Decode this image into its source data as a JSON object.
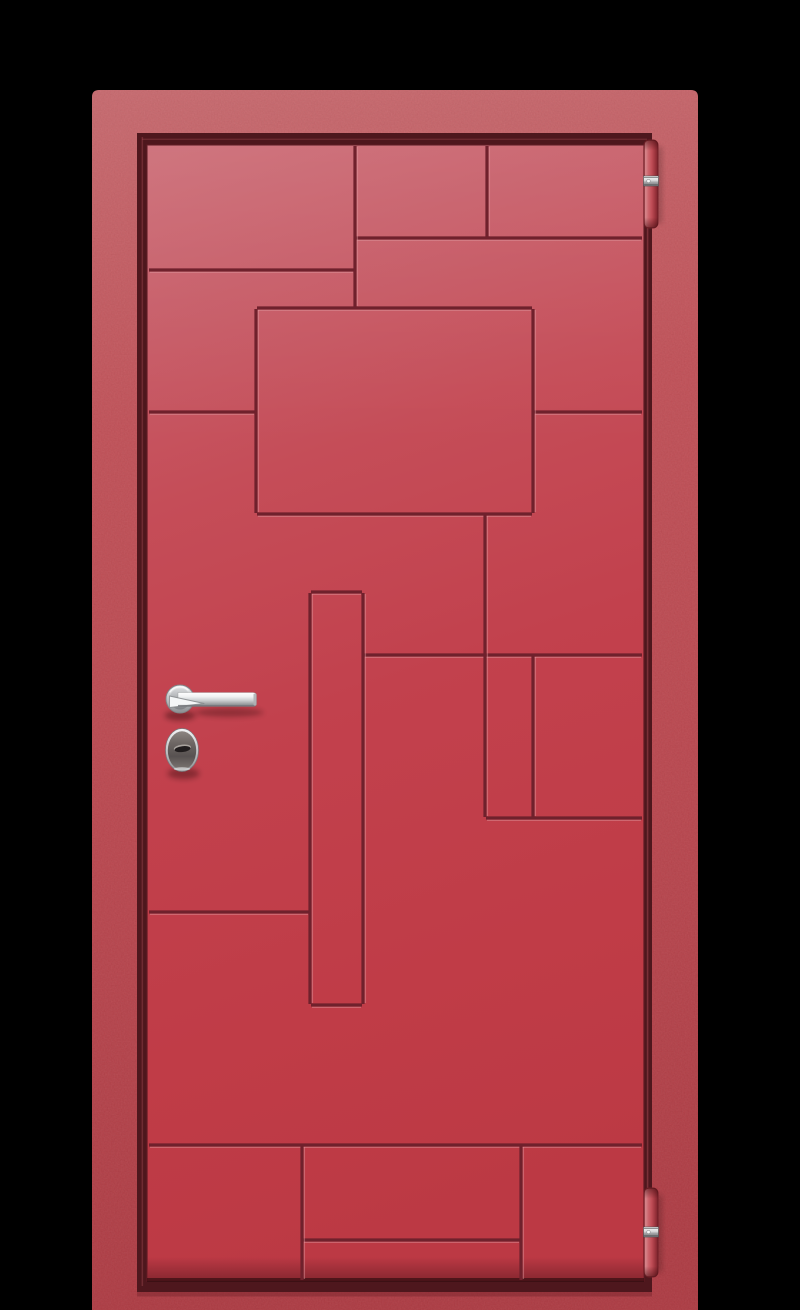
{
  "scene": {
    "type": "product-render",
    "subject": "red entry door with geometric groove pattern, chrome lever handle, oval keyhole escutcheon and two barrel hinges on black background",
    "background_color": "#000000",
    "width": 800,
    "height": 1310
  },
  "frame": {
    "x": 92,
    "y": 90,
    "right": 698,
    "bottom": 1310,
    "top_corner_radius": 7,
    "gradient": [
      [
        0,
        "#ca6c71"
      ],
      [
        0.28,
        "#c35259"
      ],
      [
        0.62,
        "#bc4850"
      ],
      [
        1,
        "#b03d45"
      ]
    ],
    "noise_opacity_light": 0.07,
    "noise_opacity_dark": 0.06,
    "rebate": {
      "x": 137,
      "y": 133,
      "right": 652,
      "bottom": 1292,
      "color": "#4e171d"
    },
    "gap_highlight_color": "#a34a52",
    "sill_shadow": {
      "y": 1292,
      "h": 4.5,
      "color": "#7c262e",
      "opacity": 0.5
    }
  },
  "leaf": {
    "x": 147,
    "y": 145,
    "right": 644,
    "bottom": 1281,
    "gradient": [
      [
        0,
        "#cb6a74"
      ],
      [
        0.13,
        "#c75d68"
      ],
      [
        0.3,
        "#c54d58"
      ],
      [
        0.52,
        "#c2414d"
      ],
      [
        0.78,
        "#c03c47"
      ],
      [
        1,
        "#bc3944"
      ]
    ],
    "edge_color": "#5e1b23",
    "bottom_shade_color": "#7c232c",
    "bottom_dark_color": "#2e0a0e",
    "sheen_height": 300,
    "sheen_opacity": 0.5
  },
  "grooves": {
    "dark_color": "#6f212c",
    "light_color": "#e09aa0",
    "dark_width": 3.2,
    "light_width": 1.3,
    "light_opacity": 0.45,
    "horizontal": [
      {
        "y": 238,
        "x1": 355,
        "x2": 643
      },
      {
        "y": 270,
        "x1": 148,
        "x2": 355
      },
      {
        "y": 308,
        "x1": 256,
        "x2": 533
      },
      {
        "y": 412,
        "x1": 148,
        "x2": 256
      },
      {
        "y": 412,
        "x1": 533,
        "x2": 643
      },
      {
        "y": 514,
        "x1": 256,
        "x2": 533
      },
      {
        "y": 592,
        "x1": 310,
        "x2": 363
      },
      {
        "y": 655,
        "x1": 363,
        "x2": 643
      },
      {
        "y": 818,
        "x1": 485,
        "x2": 643
      },
      {
        "y": 912,
        "x1": 148,
        "x2": 310
      },
      {
        "y": 1005,
        "x1": 310,
        "x2": 363
      },
      {
        "y": 1145,
        "x1": 148,
        "x2": 643
      },
      {
        "y": 1240,
        "x1": 302,
        "x2": 521
      }
    ],
    "vertical": [
      {
        "x": 355,
        "y1": 145,
        "y2": 308
      },
      {
        "x": 487,
        "y1": 145,
        "y2": 238
      },
      {
        "x": 256,
        "y1": 308,
        "y2": 514
      },
      {
        "x": 533,
        "y1": 308,
        "y2": 514
      },
      {
        "x": 310,
        "y1": 592,
        "y2": 1005
      },
      {
        "x": 363,
        "y1": 592,
        "y2": 1005
      },
      {
        "x": 485,
        "y1": 514,
        "y2": 818
      },
      {
        "x": 533,
        "y1": 655,
        "y2": 818
      },
      {
        "x": 302,
        "y1": 1145,
        "y2": 1281
      },
      {
        "x": 521,
        "y1": 1145,
        "y2": 1281
      }
    ]
  },
  "hinges": {
    "body_gradient": [
      [
        0,
        "#8e2d36"
      ],
      [
        0.1,
        "#d8898e"
      ],
      [
        0.32,
        "#cc646c"
      ],
      [
        0.55,
        "#bf4d56"
      ],
      [
        0.8,
        "#9c343d"
      ],
      [
        1,
        "#7a242c"
      ]
    ],
    "cap_shade_color": "#3c0a0e",
    "band_gradient": [
      [
        0,
        "#fafafa"
      ],
      [
        0.45,
        "#d8d9da"
      ],
      [
        0.62,
        "#a6a7a9"
      ],
      [
        1,
        "#737477"
      ]
    ],
    "outline": "#6f1d25",
    "items": [
      {
        "id": "hinge-top",
        "x": 644,
        "y": 140,
        "w": 14,
        "h": 88,
        "band_y": 176,
        "band_h": 10
      },
      {
        "id": "hinge-bottom",
        "x": 644,
        "y": 1188,
        "w": 14,
        "h": 89,
        "band_y": 1227,
        "band_h": 10
      }
    ]
  },
  "handle": {
    "rosette": {
      "cx": 180,
      "cy": 699,
      "r": 14,
      "inner_r": 10.5
    },
    "lever": {
      "x1": 178,
      "x2": 256.5,
      "top": 692.5,
      "bottom": 706.5,
      "wedge": [
        [
          169.5,
          696
        ],
        [
          169.5,
          707.5
        ],
        [
          204,
          703.5
        ]
      ]
    },
    "chrome_gradient": [
      [
        0,
        "#ffffff"
      ],
      [
        0.3,
        "#eff1f2"
      ],
      [
        0.55,
        "#ced1d3"
      ],
      [
        0.8,
        "#a0a3a6"
      ],
      [
        1,
        "#828588"
      ]
    ],
    "rosette_gradient": [
      [
        0,
        "#eceeef"
      ],
      [
        0.55,
        "#b9bcbe"
      ],
      [
        1,
        "#8b8e91"
      ]
    ],
    "rosette_inner_gradient": [
      [
        0,
        "#d6d8da"
      ],
      [
        1,
        "#7d8084"
      ]
    ],
    "wedge_fill": "#f4f6f7",
    "wedge_edge": "#85888b",
    "shadow_color": "#160304"
  },
  "lock": {
    "cx": 182,
    "cy": 750,
    "rx": 16.5,
    "ry": 21.5,
    "rim_gradient": [
      [
        0,
        "#f3f4f5"
      ],
      [
        0.5,
        "#c3c5c7"
      ],
      [
        1,
        "#8f9295"
      ]
    ],
    "face_gradient": [
      [
        0,
        "#8c8581"
      ],
      [
        0.3,
        "#6e6764"
      ],
      [
        0.65,
        "#585251"
      ],
      [
        1,
        "#7d7673"
      ]
    ],
    "keyhole": {
      "cx": 182.5,
      "cy": 748.8,
      "rx": 8,
      "ry": 2.9,
      "rotation": -7,
      "dark": "#211d1e",
      "light": "#a9a39e"
    },
    "shadow_color": "#160304"
  }
}
